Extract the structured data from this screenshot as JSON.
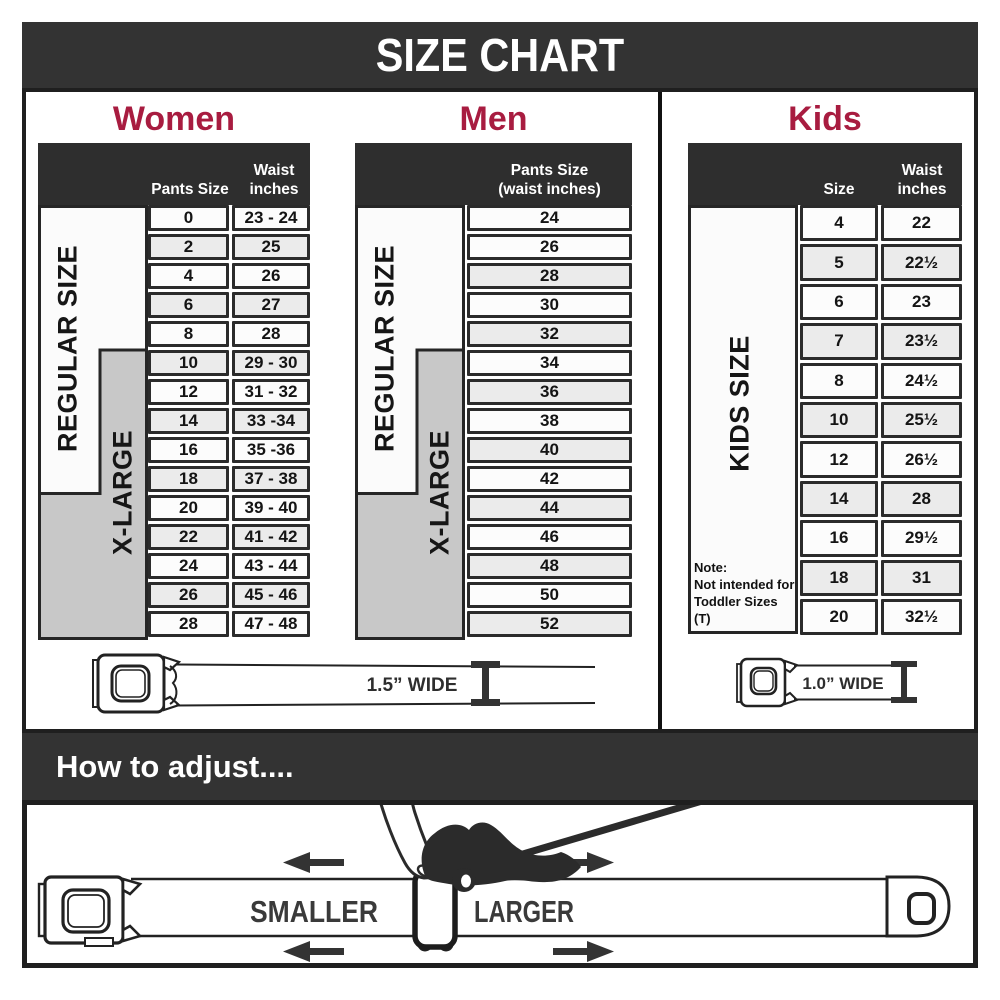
{
  "title": "SIZE CHART",
  "colors": {
    "accent": "#A81C40",
    "dark": "#333333",
    "category_gray": "#c8c8c8"
  },
  "sections": {
    "women": {
      "title": "Women",
      "col1_header": "Pants Size",
      "col2_header": "Waist inches",
      "regular_label": "REGULAR SIZE",
      "xlarge_label": "X-LARGE",
      "rows": [
        {
          "size": "0",
          "waist": "23 - 24"
        },
        {
          "size": "2",
          "waist": "25"
        },
        {
          "size": "4",
          "waist": "26"
        },
        {
          "size": "6",
          "waist": "27"
        },
        {
          "size": "8",
          "waist": "28"
        },
        {
          "size": "10",
          "waist": "29 - 30"
        },
        {
          "size": "12",
          "waist": "31 - 32"
        },
        {
          "size": "14",
          "waist": "33 -34"
        },
        {
          "size": "16",
          "waist": "35 -36"
        },
        {
          "size": "18",
          "waist": "37 - 38"
        },
        {
          "size": "20",
          "waist": "39 - 40"
        },
        {
          "size": "22",
          "waist": "41 - 42"
        },
        {
          "size": "24",
          "waist": "43 - 44"
        },
        {
          "size": "26",
          "waist": "45 - 46"
        },
        {
          "size": "28",
          "waist": "47 - 48"
        }
      ]
    },
    "men": {
      "title": "Men",
      "col_header_line1": "Pants Size",
      "col_header_line2": "(waist inches)",
      "regular_label": "REGULAR SIZE",
      "xlarge_label": "X-LARGE",
      "rows": [
        "24",
        "26",
        "28",
        "30",
        "32",
        "34",
        "36",
        "38",
        "40",
        "42",
        "44",
        "46",
        "48",
        "50",
        "52"
      ]
    },
    "kids": {
      "title": "Kids",
      "col1_header": "Size",
      "col2_header": "Waist inches",
      "size_label": "KIDS SIZE",
      "note_line1": "Note:",
      "note_line2": "Not intended for",
      "note_line3": "Toddler Sizes (T)",
      "rows": [
        {
          "size": "4",
          "waist": "22"
        },
        {
          "size": "5",
          "waist": "22½"
        },
        {
          "size": "6",
          "waist": "23"
        },
        {
          "size": "7",
          "waist": "23½"
        },
        {
          "size": "8",
          "waist": "24½"
        },
        {
          "size": "10",
          "waist": "25½"
        },
        {
          "size": "12",
          "waist": "26½"
        },
        {
          "size": "14",
          "waist": "28"
        },
        {
          "size": "16",
          "waist": "29½"
        },
        {
          "size": "18",
          "waist": "31"
        },
        {
          "size": "20",
          "waist": "32½"
        }
      ]
    }
  },
  "belts": {
    "adult_width_label": "1.5” WIDE",
    "kids_width_label": "1.0” WIDE"
  },
  "adjust": {
    "title": "How to adjust....",
    "smaller_label": "SMALLER",
    "larger_label": "LARGER"
  },
  "chart_data": [
    {
      "type": "table",
      "title": "Women",
      "columns": [
        "Pants Size",
        "Waist inches"
      ],
      "row_groups": [
        {
          "label": "REGULAR SIZE",
          "sizes": [
            "0",
            "2",
            "4",
            "6",
            "8",
            "10",
            "12",
            "14",
            "16",
            "18"
          ]
        },
        {
          "label": "X-LARGE",
          "sizes": [
            "10",
            "12",
            "14",
            "16",
            "18",
            "20",
            "22",
            "24",
            "26",
            "28"
          ]
        }
      ],
      "rows": [
        [
          "0",
          "23 - 24"
        ],
        [
          "2",
          "25"
        ],
        [
          "4",
          "26"
        ],
        [
          "6",
          "27"
        ],
        [
          "8",
          "28"
        ],
        [
          "10",
          "29 - 30"
        ],
        [
          "12",
          "31 - 32"
        ],
        [
          "14",
          "33 -34"
        ],
        [
          "16",
          "35 -36"
        ],
        [
          "18",
          "37 - 38"
        ],
        [
          "20",
          "39 - 40"
        ],
        [
          "22",
          "41 - 42"
        ],
        [
          "24",
          "43 - 44"
        ],
        [
          "26",
          "45 - 46"
        ],
        [
          "28",
          "47 - 48"
        ]
      ],
      "belt_width": "1.5” WIDE"
    },
    {
      "type": "table",
      "title": "Men",
      "columns": [
        "Pants Size (waist inches)"
      ],
      "row_groups": [
        {
          "label": "REGULAR SIZE",
          "sizes": [
            "24",
            "26",
            "28",
            "30",
            "32",
            "34",
            "36",
            "38",
            "40",
            "42"
          ]
        },
        {
          "label": "X-LARGE",
          "sizes": [
            "34",
            "36",
            "38",
            "40",
            "42",
            "44",
            "46",
            "48",
            "50",
            "52"
          ]
        }
      ],
      "rows": [
        [
          "24"
        ],
        [
          "26"
        ],
        [
          "28"
        ],
        [
          "30"
        ],
        [
          "32"
        ],
        [
          "34"
        ],
        [
          "36"
        ],
        [
          "38"
        ],
        [
          "40"
        ],
        [
          "42"
        ],
        [
          "44"
        ],
        [
          "46"
        ],
        [
          "48"
        ],
        [
          "50"
        ],
        [
          "52"
        ]
      ],
      "belt_width": "1.5” WIDE"
    },
    {
      "type": "table",
      "title": "Kids",
      "columns": [
        "Size",
        "Waist inches"
      ],
      "row_groups": [
        {
          "label": "KIDS SIZE",
          "sizes": [
            "4",
            "5",
            "6",
            "7",
            "8",
            "10",
            "12",
            "14",
            "16",
            "18",
            "20"
          ]
        }
      ],
      "note": "Note: Not intended for Toddler Sizes (T)",
      "rows": [
        [
          "4",
          "22"
        ],
        [
          "5",
          "22½"
        ],
        [
          "6",
          "23"
        ],
        [
          "7",
          "23½"
        ],
        [
          "8",
          "24½"
        ],
        [
          "10",
          "25½"
        ],
        [
          "12",
          "26½"
        ],
        [
          "14",
          "28"
        ],
        [
          "16",
          "29½"
        ],
        [
          "18",
          "31"
        ],
        [
          "20",
          "32½"
        ]
      ],
      "belt_width": "1.0” WIDE"
    }
  ]
}
